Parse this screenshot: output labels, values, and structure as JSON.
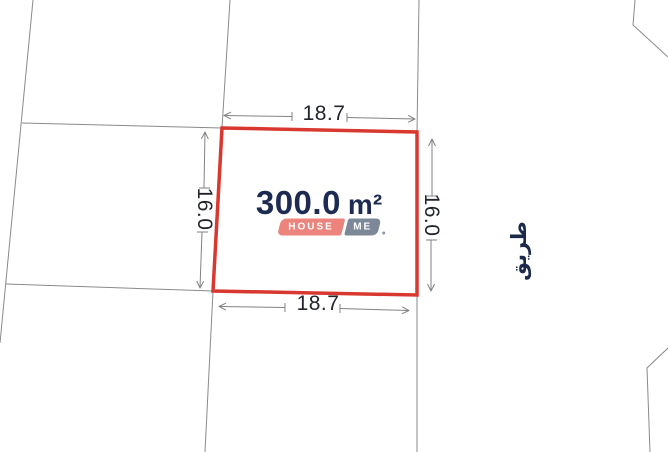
{
  "plot": {
    "area_value": "300.0",
    "area_unit": "m²",
    "dimensions": {
      "top": "18.7",
      "bottom": "18.7",
      "left": "16.0",
      "right": "16.0"
    }
  },
  "logo": {
    "house": "HOUSE",
    "me": "ME"
  },
  "road_label": "طريق",
  "colors": {
    "plot-border": "#d8382f",
    "area-text": "#1d2b52",
    "dim-text": "#23252d",
    "badge-house": "#ec837d",
    "badge-me": "#7c8798",
    "line-gray": "#8a8a8a",
    "road-text": "#1b2a4a"
  }
}
